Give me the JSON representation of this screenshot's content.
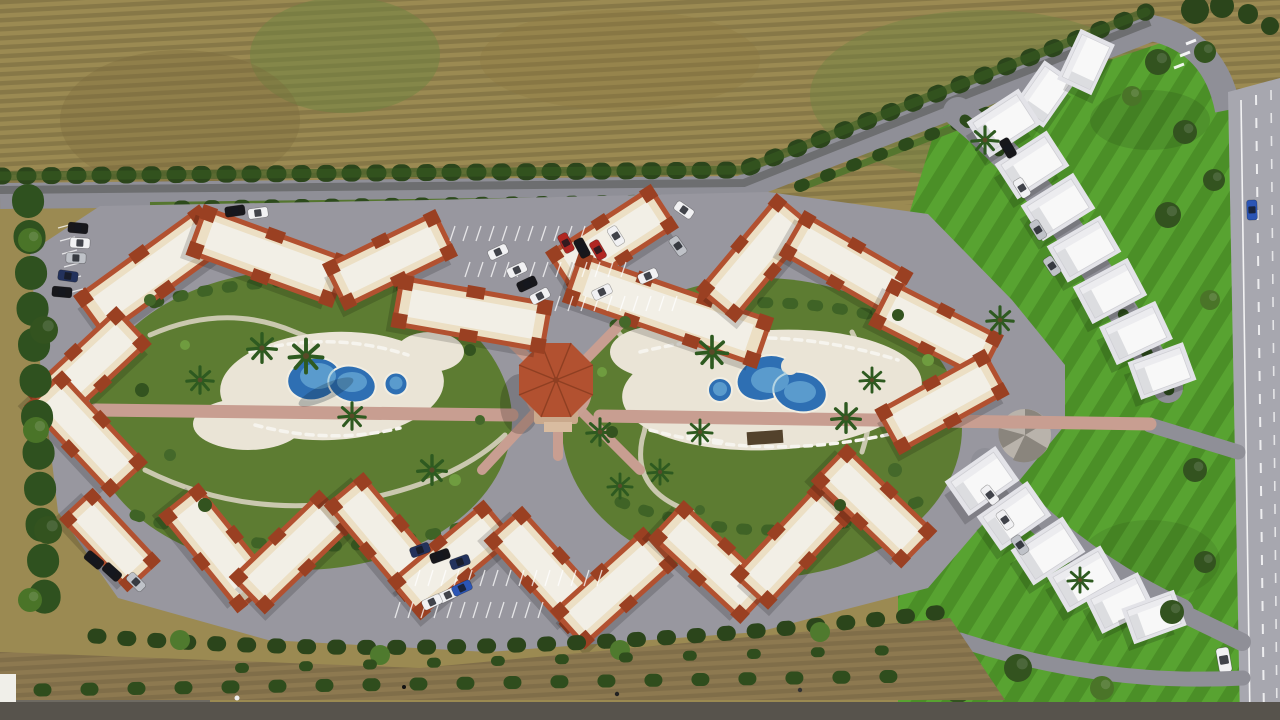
{
  "scene": {
    "title": "Aerial bird's-eye 3D render of a Mediterranean residential resort complex",
    "type": "architectural visualization",
    "regions": {
      "top_field": "fallow farm field with plough rows and green patches",
      "perimeter_hedge": "dark cypress hedge along the top boundary road",
      "top_road": "grey access road along the north edge curving to the main road",
      "main_road": "light two-lane asphalt road with dashed lane markings on the right edge",
      "complex_platform": "grey paved plot with apartment blocks, parking and gardens",
      "left_courtyard": "landscaped garden with kidney-shaped pool, round kids pool and palm trees",
      "right_courtyard": "landscaped garden with bean-shaped pool, round kids pool, sun loungers and pergola",
      "gazebo": "central octagonal pavilion with terracotta roof and radiating pink footpaths",
      "apartment_blocks": "cream low-rise blocks with white roof decks edged in terracotta tiles, arranged in zig-zag chevrons",
      "villas_top_right": "diagonal row of white flat-roof villas with cypresses between plots",
      "villas_bottom_right": "second diagonal row of white flat-roof villas",
      "right_lawn": "bright mowed lawn with scattered trees between villas and main road",
      "bottom_buffer": "dirt strip with a row of shrubs and a few pedestrians",
      "bottom_road": "dark asphalt road along the bottom edge"
    },
    "counts": {
      "apartment_clusters": 10,
      "villas": 15,
      "pools": 4,
      "gazebos": 1,
      "cars": 33,
      "parking_lots": 4
    }
  },
  "palette": {
    "field_tan": "#9b8a52",
    "field_green": "#6e8340",
    "lawn": "#4b8f27",
    "lawn_stripe": "#58a331",
    "hedge": "#2b451b",
    "tree_dark": "#33531f",
    "tree_mid": "#4a7428",
    "tree_light": "#73a143",
    "cypress": "#2c4a1b",
    "road": "#8f8f97",
    "road_main": "#a7a7af",
    "road_bottom": "#57534c",
    "platform": "#98979f",
    "paving": "#eae4d6",
    "path_pink": "#c89e91",
    "plaza_pink": "#c9a093",
    "wall": "#ecdfc4",
    "deck": "#f2efe6",
    "terracotta": "#b25130",
    "terracotta_dark": "#9a4022",
    "villa_white": "#f8f8f8",
    "villa_shade": "#dcdde0",
    "villa_pad": "#e3e3e8",
    "pool_deep": "#2e6fb3",
    "pool_light": "#7fc0e2",
    "courtyard": "#5d7c32",
    "dirt": "#8d7950",
    "car_white": "#f1f1f3",
    "car_black": "#17171b",
    "car_silver": "#bfc2c8",
    "car_red": "#b02622",
    "car_navy": "#23325c",
    "car_blue": "#2b55b5"
  }
}
